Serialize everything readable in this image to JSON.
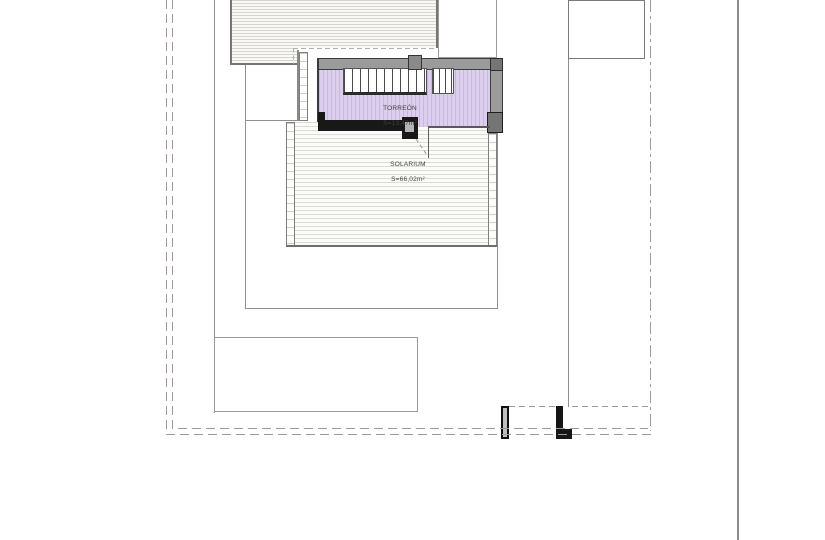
{
  "document": {
    "type": "architectural-roof-site-plan"
  },
  "rooms": {
    "torreon": {
      "name": "TORREÓN",
      "area": "S=13,47m²"
    },
    "solarium": {
      "name": "SOLARIUM",
      "area": "S=66,02m²"
    }
  },
  "colors": {
    "boundary_dash": "#a79593",
    "roof_hatch_line": "#d5d4cf",
    "solarium_hatch_line": "#dcdbd6",
    "torreon_fill": "#dccfed",
    "torreon_stripe": "#c7b6dd",
    "wall_gray": "#9b9b9b",
    "wall_dark_block": "#757575",
    "wall_black": "#181818",
    "outline_line": "#8f8f8f",
    "background": "#ffffff"
  }
}
